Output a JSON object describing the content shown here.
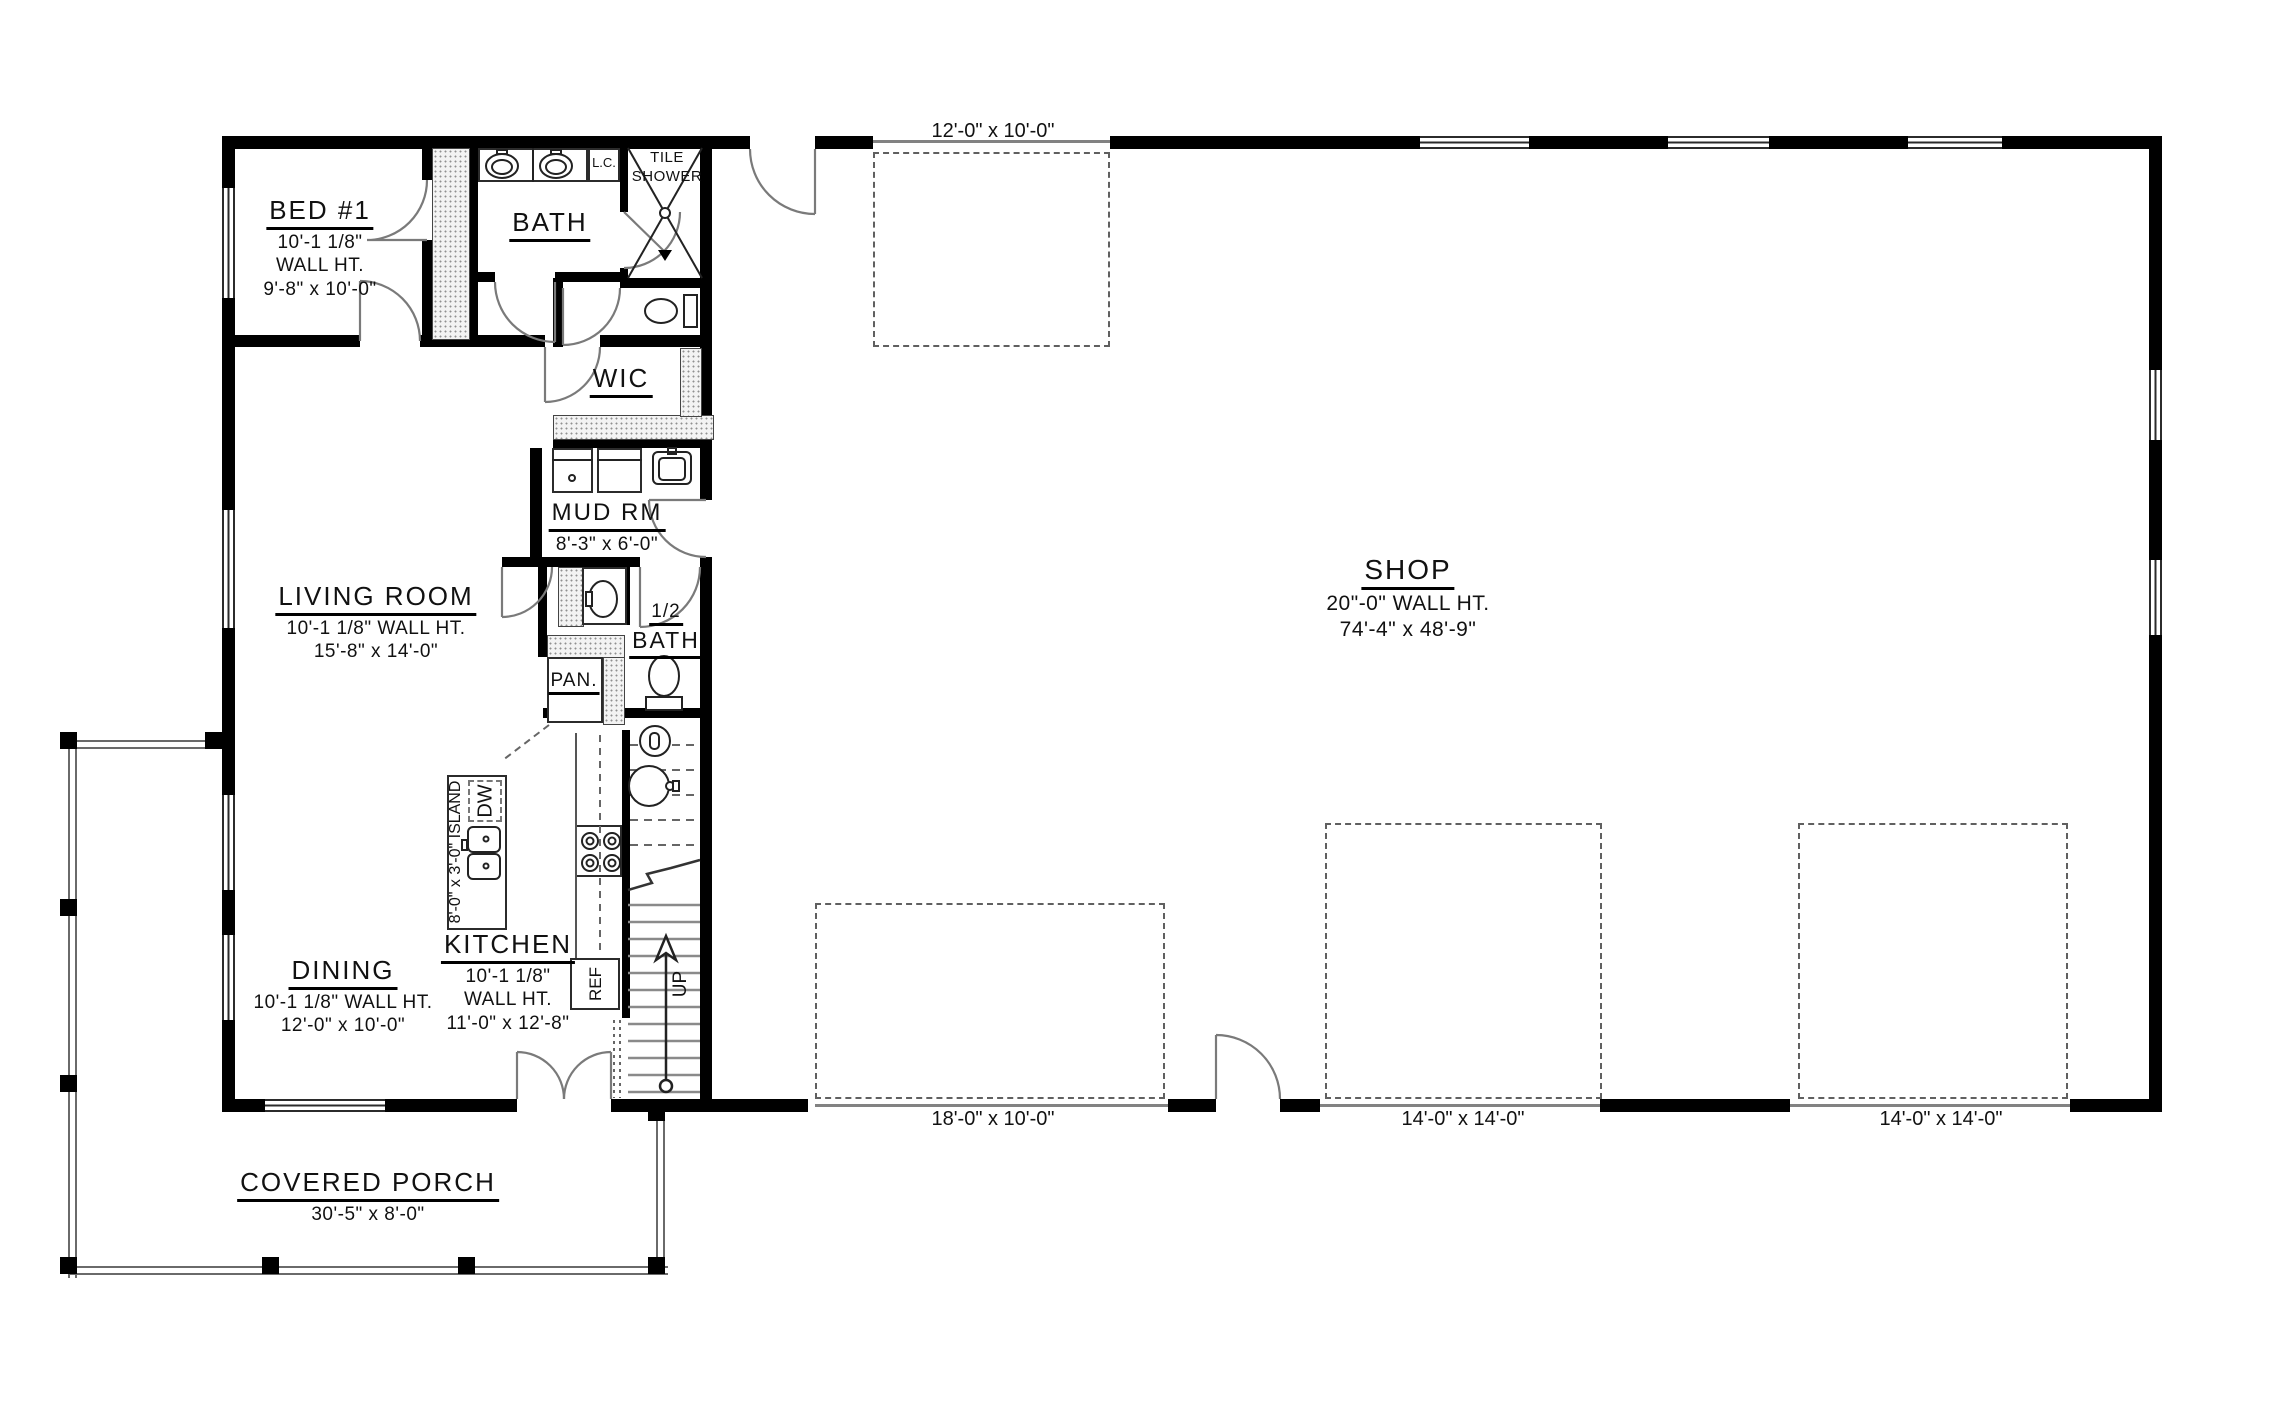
{
  "rooms": {
    "bed1": {
      "name": "BED #1",
      "wall_ht": "10'-1 1/8\"",
      "wall_ht2": "WALL HT.",
      "size": "9'-8\" x 10'-0\""
    },
    "bath": {
      "name": "BATH"
    },
    "tile_shower": {
      "name_line1": "TILE",
      "name_line2": "SHOWER"
    },
    "linen_cabinet": {
      "name": "L.C."
    },
    "wic": {
      "name": "WIC"
    },
    "mud_room": {
      "name": "MUD RM",
      "size": "8'-3\" x 6'-0\""
    },
    "living_room": {
      "name": "LIVING ROOM",
      "wall_ht": "10'-1 1/8\" WALL HT.",
      "size": "15'-8\" x 14'-0\""
    },
    "half_bath": {
      "name_line1": "1/2",
      "name_line2": "BATH"
    },
    "pantry": {
      "name": "PAN."
    },
    "kitchen": {
      "name": "KITCHEN",
      "wall_ht": "10'-1 1/8\"",
      "wall_ht2": "WALL HT.",
      "size": "11'-0\" x 12'-8\""
    },
    "dining": {
      "name": "DINING",
      "wall_ht": "10'-1 1/8\" WALL HT.",
      "size": "12'-0\" x 10'-0\""
    },
    "shop": {
      "name": "SHOP",
      "wall_ht": "20\"-0\" WALL HT.",
      "size": "74'-4\" x 48'-9\""
    },
    "covered_porch": {
      "name": "COVERED PORCH",
      "size": "30'-5\" x 8'-0\""
    }
  },
  "fixtures": {
    "island": "8'-0\" x 3'-0\" ISLAND",
    "dishwasher": "DW",
    "refrigerator": "REF",
    "stairs_up": "UP"
  },
  "openings": {
    "shop_top_garage_door": "12'-0\" x 10'-0\"",
    "shop_garage_door_1": "18'-0\" x 10'-0\"",
    "shop_garage_door_2": "14'-0\" x 14'-0\"",
    "shop_garage_door_3": "14'-0\" x 14'-0\""
  },
  "colors": {
    "wall": "#000000",
    "linework": "#6a6a6a",
    "text": "#111111",
    "background": "#ffffff"
  }
}
